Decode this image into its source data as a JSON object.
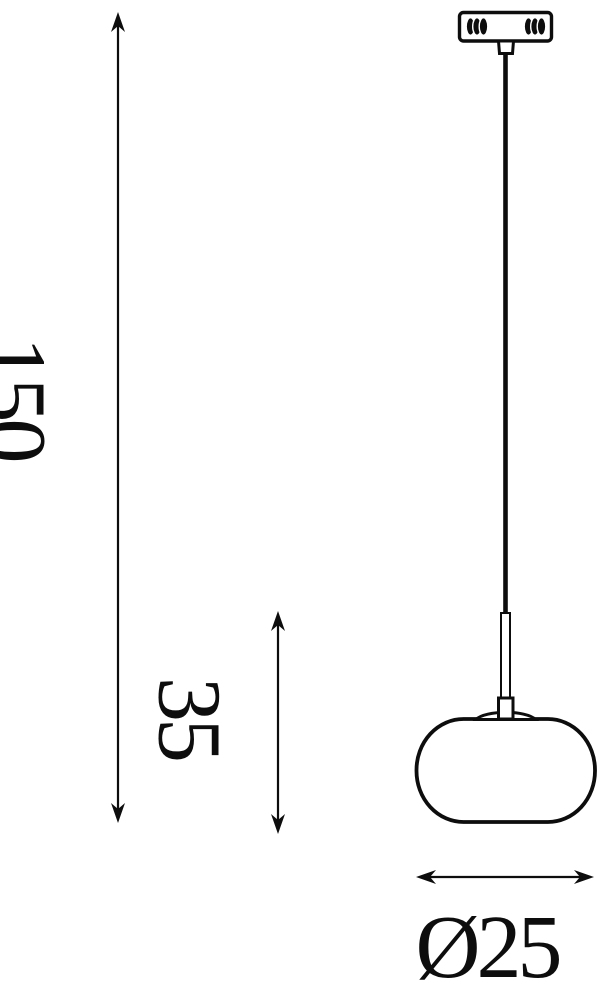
{
  "figure": {
    "kind": "pendant-lamp-dimension-diagram",
    "background_color": "#ffffff",
    "line_color": "#0d0d0d",
    "parts": [
      "ceiling-canopy",
      "canopy-coils",
      "suspension-cable",
      "stem-tube",
      "socket",
      "collar-dome",
      "glass-shade"
    ]
  },
  "dimensions": {
    "overall_height": {
      "label": "150",
      "orientation": "vertical"
    },
    "shade_height": {
      "label": "35",
      "orientation": "vertical"
    },
    "shade_diameter": {
      "label": "Ø25",
      "orientation": "horizontal"
    }
  }
}
